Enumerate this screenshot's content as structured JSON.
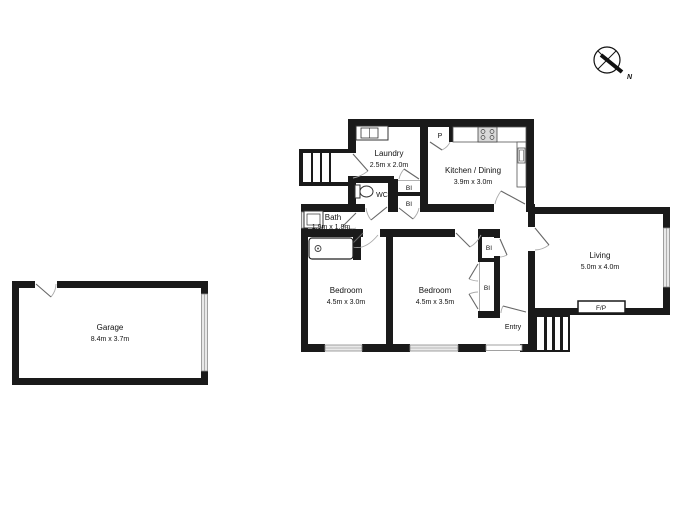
{
  "title": "Floor plan",
  "compass": {
    "north_label": "N"
  },
  "rooms": {
    "garage": {
      "name": "Garage",
      "dims": "8.4m x 3.7m"
    },
    "laundry": {
      "name": "Laundry",
      "dims": "2.5m x 2.0m"
    },
    "kitchen": {
      "name": "Kitchen / Dining",
      "dims": "3.9m x 3.0m"
    },
    "bath": {
      "name": "Bath",
      "dims": "1.9m x 1.8m"
    },
    "bedroom1": {
      "name": "Bedroom",
      "dims": "4.5m x 3.0m"
    },
    "bedroom2": {
      "name": "Bedroom",
      "dims": "4.5m x 3.5m"
    },
    "living": {
      "name": "Living",
      "dims": "5.0m x 4.0m"
    },
    "entry": {
      "name": "Entry"
    }
  },
  "labels": {
    "pantry": "P",
    "wc": "WC",
    "built_in_1": "BI",
    "built_in_2": "BI",
    "built_in_3": "BI",
    "built_in_4": "BI",
    "fireplace": "F/P"
  },
  "colors": {
    "wall": "#1a1a1a",
    "window_fill": "#e9e9e9",
    "door_arc": "#aaaaaa",
    "door_leaf": "#666666",
    "background": "#ffffff"
  }
}
